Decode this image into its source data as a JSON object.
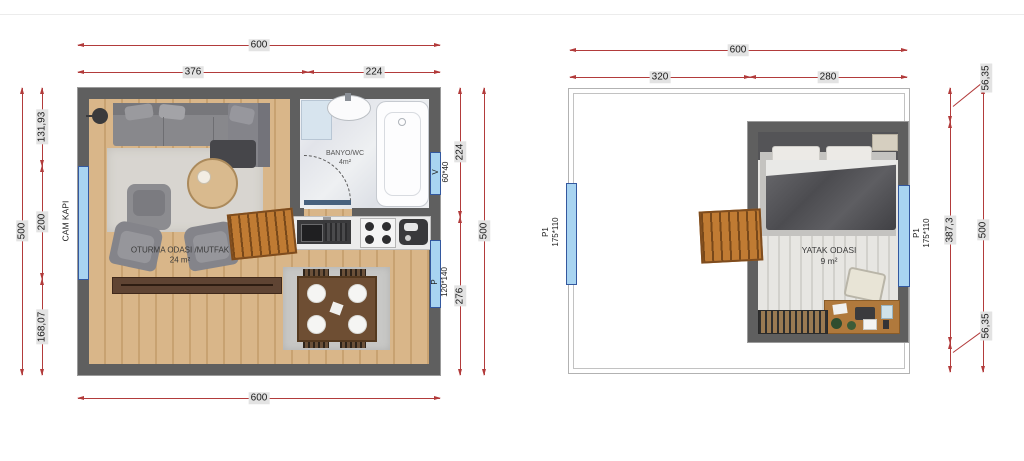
{
  "colors": {
    "dimension_red": "#b23b3b",
    "wall_gray": "#5f5f5f",
    "window_blue": "#a8d4f1",
    "window_border_blue": "#33589f",
    "wood_floor": "#d9b689",
    "stair_wood": "#c07b33"
  },
  "ground_floor": {
    "dimensions": {
      "top_total": "600",
      "top_left_segment": "376",
      "top_right_segment": "224",
      "bottom_total": "600",
      "left_total": "500",
      "left_segment_top": "131,93",
      "left_segment_middle": "200",
      "left_segment_bottom": "168,07",
      "right_total": "500",
      "right_segment_top": "224",
      "right_segment_bottom": "276"
    },
    "labels": {
      "glass_door": "CAM KAPI",
      "window_v_name": "V",
      "window_v_size": "60*40",
      "window_p_name": "P",
      "window_p_size": "120*140",
      "living_room": "OTURMA ODASI /MUTFAK",
      "living_room_area": "24 m²",
      "bathroom": "BANYO/WC",
      "bathroom_area": "4m²"
    }
  },
  "upper_floor": {
    "dimensions": {
      "top_total": "600",
      "top_left_segment": "320",
      "top_right_segment": "280",
      "right_total": "500",
      "right_segment_top": "56,35",
      "right_segment_middle": "387,3",
      "right_segment_bottom": "56,35"
    },
    "labels": {
      "window_left_name": "P1",
      "window_left_size": "175*110",
      "window_right_name": "P1",
      "window_right_size": "175*110",
      "bedroom": "YATAK ODASI",
      "bedroom_area": "9 m²"
    }
  }
}
